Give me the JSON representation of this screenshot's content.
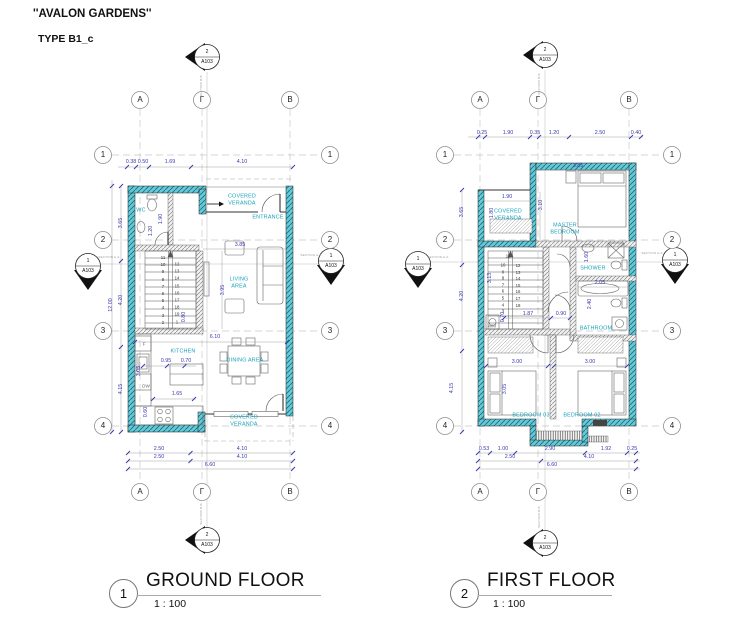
{
  "header": {
    "project_title": "''AVALON GARDENS''",
    "type_label": "TYPE B1_c"
  },
  "plans": {
    "ground": {
      "number": "1",
      "title": "GROUND FLOOR",
      "scale": "1 : 100"
    },
    "first": {
      "number": "2",
      "title": "FIRST FLOOR",
      "scale": "1 : 100"
    }
  },
  "colors": {
    "wall_teal": "#66c9d7",
    "dim_blue": "#3a3aad",
    "room_cyan": "#17a2bc"
  },
  "labels": [
    {
      "n": "gf-col-a-top",
      "t": "A",
      "x": 140,
      "y": 100,
      "c": "lb-g"
    },
    {
      "n": "gf-col-gamma-top",
      "t": "Γ",
      "x": 202,
      "y": 100,
      "c": "lb-g"
    },
    {
      "n": "gf-col-b-top",
      "t": "B",
      "x": 290,
      "y": 100,
      "c": "lb-g"
    },
    {
      "n": "gf-col-a-bot",
      "t": "A",
      "x": 140,
      "y": 492,
      "c": "lb-g"
    },
    {
      "n": "gf-col-gamma-bot",
      "t": "Γ",
      "x": 202,
      "y": 492,
      "c": "lb-g"
    },
    {
      "n": "gf-col-b-bot",
      "t": "B",
      "x": 290,
      "y": 492,
      "c": "lb-g"
    },
    {
      "n": "gf-row-1-left",
      "t": "1",
      "x": 103,
      "y": 155,
      "c": "lb-g"
    },
    {
      "n": "gf-row-2-left",
      "t": "2",
      "x": 103,
      "y": 240,
      "c": "lb-g"
    },
    {
      "n": "gf-row-3-left",
      "t": "3",
      "x": 103,
      "y": 331,
      "c": "lb-g"
    },
    {
      "n": "gf-row-4-left",
      "t": "4",
      "x": 103,
      "y": 426,
      "c": "lb-g"
    },
    {
      "n": "gf-row-1-right",
      "t": "1",
      "x": 330,
      "y": 155,
      "c": "lb-g"
    },
    {
      "n": "gf-row-2-right",
      "t": "2",
      "x": 330,
      "y": 240,
      "c": "lb-g"
    },
    {
      "n": "gf-row-3-right",
      "t": "3",
      "x": 330,
      "y": 331,
      "c": "lb-g"
    },
    {
      "n": "gf-row-4-right",
      "t": "4",
      "x": 330,
      "y": 426,
      "c": "lb-g"
    },
    {
      "n": "gf-sect-top-num",
      "t": "2",
      "x": 207,
      "y": 52,
      "c": "lb-m"
    },
    {
      "n": "gf-sect-top-sheet",
      "t": "A103",
      "x": 207,
      "y": 62,
      "c": "lb-m"
    },
    {
      "n": "gf-sect-left-num",
      "t": "1",
      "x": 88,
      "y": 261,
      "c": "lb-m"
    },
    {
      "n": "gf-sect-left-sheet",
      "t": "A103",
      "x": 88,
      "y": 271,
      "c": "lb-m"
    },
    {
      "n": "gf-sect-right-num",
      "t": "1",
      "x": 331,
      "y": 256,
      "c": "lb-m"
    },
    {
      "n": "gf-sect-right-sheet",
      "t": "A103",
      "x": 331,
      "y": 266,
      "c": "lb-m"
    },
    {
      "n": "gf-sect-bot-num",
      "t": "2",
      "x": 207,
      "y": 535,
      "c": "lb-m"
    },
    {
      "n": "gf-sect-bot-sheet",
      "t": "A103",
      "x": 207,
      "y": 545,
      "c": "lb-m"
    },
    {
      "n": "gf-dim-038",
      "t": "0.38",
      "x": 131,
      "y": 162,
      "c": "lb-d"
    },
    {
      "n": "gf-dim-050",
      "t": "0.50",
      "x": 143,
      "y": 162,
      "c": "lb-d"
    },
    {
      "n": "gf-dim-169",
      "t": "1.69",
      "x": 170,
      "y": 162,
      "c": "lb-d"
    },
    {
      "n": "gf-dim-410-top",
      "t": "4.10",
      "x": 242,
      "y": 162,
      "c": "lb-d"
    },
    {
      "n": "gf-dim-250-b1",
      "t": "2.50",
      "x": 159,
      "y": 449,
      "c": "lb-d"
    },
    {
      "n": "gf-dim-410-b1",
      "t": "4.10",
      "x": 242,
      "y": 449,
      "c": "lb-d"
    },
    {
      "n": "gf-dim-250-b2",
      "t": "2.50",
      "x": 159,
      "y": 457,
      "c": "lb-d"
    },
    {
      "n": "gf-dim-410-b2",
      "t": "4.10",
      "x": 242,
      "y": 457,
      "c": "lb-d"
    },
    {
      "n": "gf-dim-660",
      "t": "6.60",
      "x": 210,
      "y": 465,
      "c": "lb-d"
    },
    {
      "n": "gf-dim-365",
      "t": "3.65",
      "x": 121,
      "y": 223,
      "c": "lb-d rot"
    },
    {
      "n": "gf-dim-420",
      "t": "4.20",
      "x": 121,
      "y": 300,
      "c": "lb-d rot"
    },
    {
      "n": "gf-dim-415",
      "t": "4.15",
      "x": 121,
      "y": 389,
      "c": "lb-d rot"
    },
    {
      "n": "gf-dim-1200",
      "t": "12.00",
      "x": 111,
      "y": 305,
      "c": "lb-d rot"
    },
    {
      "n": "gf-dim-120",
      "t": "1.20",
      "x": 151,
      "y": 231,
      "c": "lb-d rot"
    },
    {
      "n": "gf-dim-190",
      "t": "1.90",
      "x": 161,
      "y": 219,
      "c": "lb-d rot"
    },
    {
      "n": "gf-dim-385",
      "t": "3.85",
      "x": 240,
      "y": 245,
      "c": "lb-d"
    },
    {
      "n": "gf-dim-395",
      "t": "3.95",
      "x": 223,
      "y": 290,
      "c": "lb-d rot"
    },
    {
      "n": "gf-dim-080",
      "t": "0.80",
      "x": 184,
      "y": 317,
      "c": "lb-d rot"
    },
    {
      "n": "gf-dim-610",
      "t": "6.10",
      "x": 215,
      "y": 337,
      "c": "lb-d"
    },
    {
      "n": "gf-dim-095",
      "t": "0.95",
      "x": 166,
      "y": 361,
      "c": "lb-d"
    },
    {
      "n": "gf-dim-070",
      "t": "0.70",
      "x": 186,
      "y": 361,
      "c": "lb-d"
    },
    {
      "n": "gf-dim-165",
      "t": "1.65",
      "x": 177,
      "y": 394,
      "c": "lb-d"
    },
    {
      "n": "gf-dim-305",
      "t": "3.05",
      "x": 139,
      "y": 371,
      "c": "lb-d rot"
    },
    {
      "n": "gf-dim-060",
      "t": "0.60",
      "x": 146,
      "y": 412,
      "c": "lb-d rot"
    },
    {
      "n": "gf-room-wc",
      "t": "WC",
      "x": 141,
      "y": 211,
      "c": "lb-r"
    },
    {
      "n": "gf-room-cov-veranda-top",
      "t": "COVERED\nVERANDA",
      "x": 242,
      "y": 200,
      "c": "lb-r"
    },
    {
      "n": "gf-room-entrance",
      "t": "ENTRANCE",
      "x": 268,
      "y": 218,
      "c": "lb-r"
    },
    {
      "n": "gf-room-living",
      "t": "LIVING\nAREA",
      "x": 239,
      "y": 283,
      "c": "lb-r"
    },
    {
      "n": "gf-room-kitchen",
      "t": "KITCHEN",
      "x": 183,
      "y": 352,
      "c": "lb-r"
    },
    {
      "n": "gf-room-dining",
      "t": "DINING AREA",
      "x": 245,
      "y": 361,
      "c": "lb-r"
    },
    {
      "n": "gf-room-cov-veranda-bot",
      "t": "COVERED\nVERANDA",
      "x": 244,
      "y": 421,
      "c": "lb-r"
    },
    {
      "n": "gf-fridge-label",
      "t": "F",
      "x": 144,
      "y": 344,
      "c": "lb-a"
    },
    {
      "n": "gf-dishwasher-label",
      "t": "DW",
      "x": 146,
      "y": 386,
      "c": "lb-a"
    },
    {
      "n": "gf-stair-numbers-left",
      "t": "11\n10\n9\n8\n7\n6\n5\n4\n3\n2",
      "x": 163,
      "y": 290,
      "c": "lb-s"
    },
    {
      "n": "gf-stair-numbers-right",
      "t": "12\n13\n14\n15\n16\n17\n18\n19\n1",
      "x": 177,
      "y": 293,
      "c": "lb-s"
    },
    {
      "n": "gf-section-text-left",
      "t": "SECTION A-A",
      "x": 109,
      "y": 258,
      "c": "lb-t"
    },
    {
      "n": "gf-section-text-right",
      "t": "SECTION A-A",
      "x": 311,
      "y": 256,
      "c": "lb-t"
    },
    {
      "n": "gf-section-text-top",
      "t": "SECTION B-B",
      "x": 202,
      "y": 86,
      "c": "lb-t rot"
    },
    {
      "n": "gf-section-text-bot",
      "t": "SECTION B-B",
      "x": 202,
      "y": 514,
      "c": "lb-t rot"
    },
    {
      "n": "ff-col-a-top",
      "t": "A",
      "x": 480,
      "y": 100,
      "c": "lb-g"
    },
    {
      "n": "ff-col-gamma-top",
      "t": "Γ",
      "x": 538,
      "y": 100,
      "c": "lb-g"
    },
    {
      "n": "ff-col-b-top",
      "t": "B",
      "x": 629,
      "y": 100,
      "c": "lb-g"
    },
    {
      "n": "ff-col-a-bot",
      "t": "A",
      "x": 480,
      "y": 492,
      "c": "lb-g"
    },
    {
      "n": "ff-col-gamma-bot",
      "t": "Γ",
      "x": 538,
      "y": 492,
      "c": "lb-g"
    },
    {
      "n": "ff-col-b-bot",
      "t": "B",
      "x": 629,
      "y": 492,
      "c": "lb-g"
    },
    {
      "n": "ff-row-1-left",
      "t": "1",
      "x": 445,
      "y": 155,
      "c": "lb-g"
    },
    {
      "n": "ff-row-2-left",
      "t": "2",
      "x": 445,
      "y": 240,
      "c": "lb-g"
    },
    {
      "n": "ff-row-3-left",
      "t": "3",
      "x": 445,
      "y": 331,
      "c": "lb-g"
    },
    {
      "n": "ff-row-4-left",
      "t": "4",
      "x": 445,
      "y": 426,
      "c": "lb-g"
    },
    {
      "n": "ff-row-1-right",
      "t": "1",
      "x": 672,
      "y": 155,
      "c": "lb-g"
    },
    {
      "n": "ff-row-2-right",
      "t": "2",
      "x": 672,
      "y": 240,
      "c": "lb-g"
    },
    {
      "n": "ff-row-3-right",
      "t": "3",
      "x": 672,
      "y": 331,
      "c": "lb-g"
    },
    {
      "n": "ff-row-4-right",
      "t": "4",
      "x": 672,
      "y": 426,
      "c": "lb-g"
    },
    {
      "n": "ff-sect-top-num",
      "t": "2",
      "x": 545,
      "y": 50,
      "c": "lb-m"
    },
    {
      "n": "ff-sect-top-sheet",
      "t": "A103",
      "x": 545,
      "y": 60,
      "c": "lb-m"
    },
    {
      "n": "ff-sect-left-num",
      "t": "1",
      "x": 418,
      "y": 259,
      "c": "lb-m"
    },
    {
      "n": "ff-sect-left-sheet",
      "t": "A103",
      "x": 418,
      "y": 269,
      "c": "lb-m"
    },
    {
      "n": "ff-sect-right-num",
      "t": "1",
      "x": 675,
      "y": 255,
      "c": "lb-m"
    },
    {
      "n": "ff-sect-right-sheet",
      "t": "A103",
      "x": 675,
      "y": 265,
      "c": "lb-m"
    },
    {
      "n": "ff-sect-bot-num",
      "t": "2",
      "x": 545,
      "y": 538,
      "c": "lb-m"
    },
    {
      "n": "ff-sect-bot-sheet",
      "t": "A103",
      "x": 545,
      "y": 548,
      "c": "lb-m"
    },
    {
      "n": "ff-dim-025-top",
      "t": "0.25",
      "x": 482,
      "y": 133,
      "c": "lb-d"
    },
    {
      "n": "ff-dim-190-top",
      "t": "1.90",
      "x": 508,
      "y": 133,
      "c": "lb-d"
    },
    {
      "n": "ff-dim-035-top",
      "t": "0.35",
      "x": 535,
      "y": 133,
      "c": "lb-d"
    },
    {
      "n": "ff-dim-120-top",
      "t": "1.20",
      "x": 554,
      "y": 133,
      "c": "lb-d"
    },
    {
      "n": "ff-dim-250-top",
      "t": "2.50",
      "x": 600,
      "y": 133,
      "c": "lb-d"
    },
    {
      "n": "ff-dim-040-top",
      "t": "0.40",
      "x": 636,
      "y": 133,
      "c": "lb-d"
    },
    {
      "n": "ff-dim-053",
      "t": "0.53",
      "x": 484,
      "y": 449,
      "c": "lb-d"
    },
    {
      "n": "ff-dim-100",
      "t": "1.00",
      "x": 503,
      "y": 449,
      "c": "lb-d"
    },
    {
      "n": "ff-dim-290",
      "t": "2.90",
      "x": 550,
      "y": 449,
      "c": "lb-d"
    },
    {
      "n": "ff-dim-192",
      "t": "1.92",
      "x": 606,
      "y": 449,
      "c": "lb-d"
    },
    {
      "n": "ff-dim-025-bot",
      "t": "0.25",
      "x": 632,
      "y": 449,
      "c": "lb-d"
    },
    {
      "n": "ff-dim-250-bot",
      "t": "2.50",
      "x": 510,
      "y": 457,
      "c": "lb-d"
    },
    {
      "n": "ff-dim-410-bot",
      "t": "4.10",
      "x": 589,
      "y": 457,
      "c": "lb-d"
    },
    {
      "n": "ff-dim-660",
      "t": "6.60",
      "x": 552,
      "y": 465,
      "c": "lb-d"
    },
    {
      "n": "ff-dim-365",
      "t": "3.65",
      "x": 462,
      "y": 212,
      "c": "lb-d rot"
    },
    {
      "n": "ff-dim-420",
      "t": "4.20",
      "x": 462,
      "y": 296,
      "c": "lb-d rot"
    },
    {
      "n": "ff-dim-415",
      "t": "4.15",
      "x": 452,
      "y": 388,
      "c": "lb-d rot"
    },
    {
      "n": "ff-dim-190-in",
      "t": "1.90",
      "x": 507,
      "y": 197,
      "c": "lb-d"
    },
    {
      "n": "ff-dim-180",
      "t": "1.80",
      "x": 492,
      "y": 213,
      "c": "lb-d rot"
    },
    {
      "n": "ff-dim-310",
      "t": "3.10",
      "x": 541,
      "y": 205,
      "c": "lb-d rot"
    },
    {
      "n": "ff-dim-385",
      "t": "3.85",
      "x": 578,
      "y": 166,
      "c": "lb-d"
    },
    {
      "n": "ff-dim-160",
      "t": "1.60",
      "x": 587,
      "y": 257,
      "c": "lb-d rot"
    },
    {
      "n": "ff-dim-205",
      "t": "2.05",
      "x": 600,
      "y": 283,
      "c": "lb-d"
    },
    {
      "n": "ff-dim-240",
      "t": "2.40",
      "x": 590,
      "y": 304,
      "c": "lb-d rot"
    },
    {
      "n": "ff-dim-313",
      "t": "3.13",
      "x": 490,
      "y": 278,
      "c": "lb-d rot"
    },
    {
      "n": "ff-dim-070",
      "t": "0.70",
      "x": 503,
      "y": 317,
      "c": "lb-d rot"
    },
    {
      "n": "ff-dim-187",
      "t": "1.87",
      "x": 528,
      "y": 314,
      "c": "lb-d"
    },
    {
      "n": "ff-dim-090",
      "t": "0.90",
      "x": 561,
      "y": 314,
      "c": "lb-d"
    },
    {
      "n": "ff-dim-300-a",
      "t": "3.00",
      "x": 517,
      "y": 362,
      "c": "lb-d"
    },
    {
      "n": "ff-dim-300-b",
      "t": "3.00",
      "x": 590,
      "y": 362,
      "c": "lb-d"
    },
    {
      "n": "ff-dim-305",
      "t": "3.05",
      "x": 505,
      "y": 389,
      "c": "lb-d rot"
    },
    {
      "n": "ff-room-cov-veranda",
      "t": "COVERED\nVERANDA",
      "x": 508,
      "y": 215,
      "c": "lb-r"
    },
    {
      "n": "ff-room-master",
      "t": "MASTER\nBEDROOM",
      "x": 565,
      "y": 229,
      "c": "lb-r"
    },
    {
      "n": "ff-room-shower",
      "t": "SHOWER",
      "x": 593,
      "y": 269,
      "c": "lb-r"
    },
    {
      "n": "ff-room-bathroom",
      "t": "BATHROOM",
      "x": 596,
      "y": 329,
      "c": "lb-r"
    },
    {
      "n": "ff-room-bedroom03",
      "t": "BEDROOM 03",
      "x": 531,
      "y": 416,
      "c": "lb-r"
    },
    {
      "n": "ff-room-bedroom02",
      "t": "BEDROOM 02",
      "x": 582,
      "y": 416,
      "c": "lb-r"
    },
    {
      "n": "ff-wm-label",
      "t": "WM",
      "x": 492,
      "y": 326,
      "c": "lb-a"
    },
    {
      "n": "ff-stair-num-top",
      "t": "11",
      "x": 508,
      "y": 257,
      "c": "lb-s2"
    },
    {
      "n": "ff-stair-numbers-left",
      "t": "10\n9\n8\n7\n6\n5\n4\n3",
      "x": 503,
      "y": 289,
      "c": "lb-s2"
    },
    {
      "n": "ff-stair-numbers-right",
      "t": "12\n13\n14\n15\n16\n17\n18",
      "x": 518,
      "y": 286,
      "c": "lb-s2"
    },
    {
      "n": "ff-section-text-left",
      "t": "SECTION A-A",
      "x": 438,
      "y": 258,
      "c": "lb-t"
    },
    {
      "n": "ff-section-text-right",
      "t": "SECTION A-A",
      "x": 652,
      "y": 254,
      "c": "lb-t"
    },
    {
      "n": "ff-section-text-top",
      "t": "SECTION B-B",
      "x": 540,
      "y": 84,
      "c": "lb-t rot"
    },
    {
      "n": "ff-section-text-bot",
      "t": "SECTION B-B",
      "x": 540,
      "y": 517,
      "c": "lb-t rot"
    }
  ]
}
